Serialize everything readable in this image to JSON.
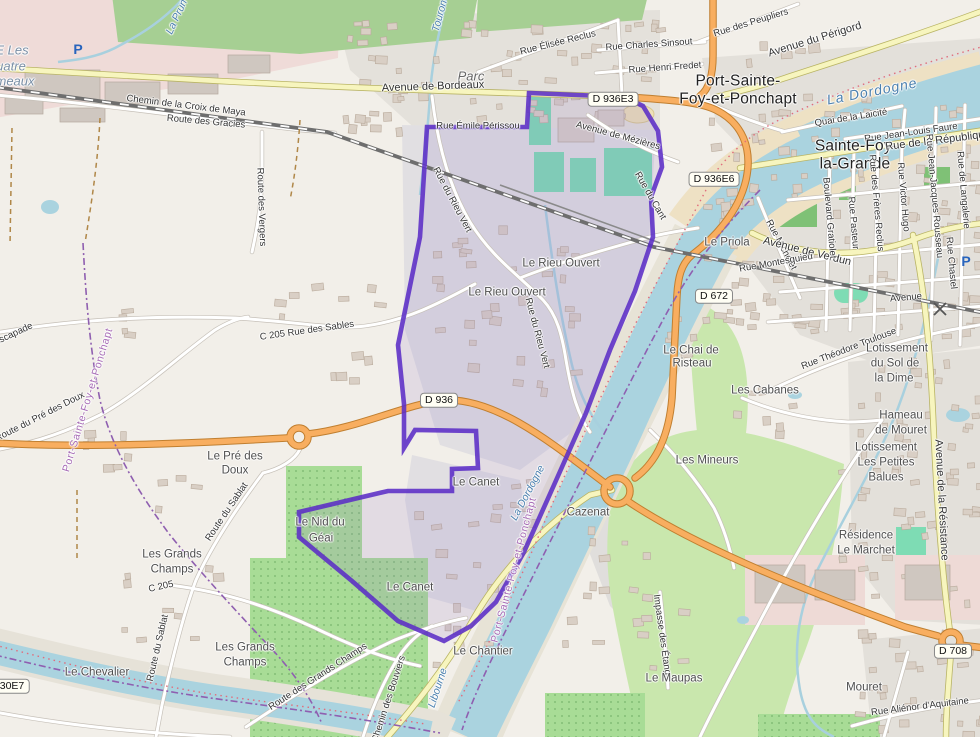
{
  "map_title": "Port-Sainte-Foy-et-Ponchapt commune boundary map",
  "boundary": {
    "name": "Port-Sainte-Foy-et-Ponchapt",
    "stroke_color": "#5b2ec6"
  },
  "colors": {
    "water": "#aad3df",
    "land": "#f2efe9",
    "forest": "#a6cf93",
    "grass": "#c9e7ad",
    "orchard": "#a8dc96",
    "pitch": "#7edcb4",
    "residential": "#e2e0db",
    "industrial": "#efdbd8",
    "primary_road": "#f8ae60",
    "secondary_road": "#f7f5be",
    "boundary_purple": "#5b2ec6",
    "railway": "#6e6e6e"
  },
  "labels": [
    {
      "t": "E Les",
      "x": 12,
      "y": 50,
      "r": 0,
      "k": "land"
    },
    {
      "t": "uatre",
      "x": 11,
      "y": 66,
      "r": 0,
      "k": "land"
    },
    {
      "t": "meaux",
      "x": 15,
      "y": 81,
      "r": 0,
      "k": "land"
    },
    {
      "t": "La Prun",
      "x": 177,
      "y": 17,
      "r": -65,
      "k": "wat"
    },
    {
      "t": "P",
      "x": 78,
      "y": 49,
      "r": 0,
      "k": "pk"
    },
    {
      "t": "Chemin de la Croix de Maya",
      "x": 186,
      "y": 106,
      "r": 7,
      "k": "road"
    },
    {
      "t": "Route des Gracies",
      "x": 206,
      "y": 122,
      "r": 5,
      "k": "road"
    },
    {
      "t": "Route des Vergers",
      "x": 261,
      "y": 207,
      "r": 88,
      "k": "road"
    },
    {
      "t": "Touron",
      "x": 440,
      "y": 16,
      "r": -75,
      "k": "wat"
    },
    {
      "t": "Parc",
      "x": 471,
      "y": 76,
      "r": 0,
      "k": "park"
    },
    {
      "t": "Avenue de Bordeaux",
      "x": 433,
      "y": 87,
      "r": -2,
      "k": "ryel"
    },
    {
      "t": "Rue Élisée Reclus",
      "x": 558,
      "y": 43,
      "r": -14,
      "k": "road"
    },
    {
      "t": "Rue Charles Sinsout",
      "x": 649,
      "y": 45,
      "r": -4,
      "k": "road"
    },
    {
      "t": "Rue Henri Fredet",
      "x": 665,
      "y": 68,
      "r": -4,
      "k": "road"
    },
    {
      "t": "Rue des Peupliers",
      "x": 751,
      "y": 23,
      "r": -17,
      "k": "road"
    },
    {
      "t": "Avenue du Périgord",
      "x": 815,
      "y": 40,
      "r": -17,
      "k": "ryel"
    },
    {
      "t": "Port-Sainte-",
      "x": 738,
      "y": 81,
      "r": 0,
      "k": "town"
    },
    {
      "t": "Foy-et-Ponchapt",
      "x": 738,
      "y": 99,
      "r": 0,
      "k": "town"
    },
    {
      "t": "La Dordogne",
      "x": 872,
      "y": 91,
      "r": -11,
      "k": "watb"
    },
    {
      "t": "Quai de la Laicité",
      "x": 851,
      "y": 118,
      "r": -9,
      "k": "road"
    },
    {
      "t": "Rue Jean-Louis Faure",
      "x": 911,
      "y": 133,
      "r": -8,
      "k": "road"
    },
    {
      "t": "Sainte-Foy-",
      "x": 856,
      "y": 146,
      "r": 0,
      "k": "town"
    },
    {
      "t": "la-Grande",
      "x": 855,
      "y": 164,
      "r": 0,
      "k": "town"
    },
    {
      "t": "Rue de la République",
      "x": 938,
      "y": 141,
      "r": -7,
      "k": "ryel"
    },
    {
      "t": "D 936E3",
      "x": 613,
      "y": 99,
      "r": 0,
      "k": "shld"
    },
    {
      "t": "D 936E6",
      "x": 714,
      "y": 179,
      "r": 0,
      "k": "shld"
    },
    {
      "t": "Rue Émile Périssou",
      "x": 478,
      "y": 126,
      "r": 0,
      "k": "road"
    },
    {
      "t": "Avenue de Mézières",
      "x": 618,
      "y": 136,
      "r": 15,
      "k": "road"
    },
    {
      "t": "Rue du Cant",
      "x": 650,
      "y": 196,
      "r": 60,
      "k": "road"
    },
    {
      "t": "Le Priola",
      "x": 727,
      "y": 243,
      "r": 0,
      "k": "sub"
    },
    {
      "t": "Rue Michelet",
      "x": 781,
      "y": 245,
      "r": 62,
      "k": "road"
    },
    {
      "t": "Avenue de Verdun",
      "x": 807,
      "y": 252,
      "r": 14,
      "k": "ryel"
    },
    {
      "t": "Rue Montesquieu",
      "x": 776,
      "y": 263,
      "r": -10,
      "k": "road"
    },
    {
      "t": "Boulevard Gratiolet",
      "x": 829,
      "y": 218,
      "r": 85,
      "k": "road"
    },
    {
      "t": "Rue Pasteur",
      "x": 853,
      "y": 223,
      "r": 85,
      "k": "road"
    },
    {
      "t": "Rue des Frères Reclus",
      "x": 876,
      "y": 203,
      "r": 85,
      "k": "road"
    },
    {
      "t": "Rue Victor Hugo",
      "x": 903,
      "y": 197,
      "r": 85,
      "k": "road"
    },
    {
      "t": "Rue Jean-Jacques Rousseau",
      "x": 934,
      "y": 196,
      "r": 85,
      "k": "road"
    },
    {
      "t": "Rue de Langalerie",
      "x": 963,
      "y": 190,
      "r": 85,
      "k": "road"
    },
    {
      "t": "Rue Chastel",
      "x": 951,
      "y": 263,
      "r": 85,
      "k": "road"
    },
    {
      "t": "Avenue",
      "x": 906,
      "y": 298,
      "r": -5,
      "k": "road"
    },
    {
      "t": "P",
      "x": 966,
      "y": 261,
      "r": 0,
      "k": "pk"
    },
    {
      "t": "D 672",
      "x": 714,
      "y": 296,
      "r": 0,
      "k": "shld"
    },
    {
      "t": "Rue Théodore Toulouse",
      "x": 849,
      "y": 349,
      "r": -21,
      "k": "road"
    },
    {
      "t": "Le Chai de",
      "x": 691,
      "y": 351,
      "r": 0,
      "k": "sub"
    },
    {
      "t": "Risteau",
      "x": 692,
      "y": 364,
      "r": 0,
      "k": "sub"
    },
    {
      "t": "Les Cabanes",
      "x": 765,
      "y": 391,
      "r": 0,
      "k": "sub"
    },
    {
      "t": "Lotissement",
      "x": 897,
      "y": 349,
      "r": 0,
      "k": "sub"
    },
    {
      "t": "du Sol de",
      "x": 895,
      "y": 364,
      "r": 0,
      "k": "sub"
    },
    {
      "t": "la Dime",
      "x": 894,
      "y": 379,
      "r": 0,
      "k": "sub"
    },
    {
      "t": "Hameau",
      "x": 901,
      "y": 416,
      "r": 0,
      "k": "sub"
    },
    {
      "t": "de Mouret",
      "x": 901,
      "y": 431,
      "r": 0,
      "k": "sub"
    },
    {
      "t": "Lotissement",
      "x": 886,
      "y": 448,
      "r": 0,
      "k": "sub"
    },
    {
      "t": "Les Petites",
      "x": 886,
      "y": 463,
      "r": 0,
      "k": "sub"
    },
    {
      "t": "Balues",
      "x": 886,
      "y": 478,
      "r": 0,
      "k": "sub"
    },
    {
      "t": "Les Mineurs",
      "x": 707,
      "y": 461,
      "r": 0,
      "k": "sub"
    },
    {
      "t": "Avenue de la Résistance",
      "x": 941,
      "y": 500,
      "r": 87,
      "k": "ryel"
    },
    {
      "t": "Résidence",
      "x": 866,
      "y": 536,
      "r": 0,
      "k": "sub"
    },
    {
      "t": "Le Marchet",
      "x": 866,
      "y": 551,
      "r": 0,
      "k": "sub"
    },
    {
      "t": "Impasse des Étangs",
      "x": 662,
      "y": 637,
      "r": 82,
      "k": "road"
    },
    {
      "t": "Le Maupas",
      "x": 674,
      "y": 679,
      "r": 0,
      "k": "sub"
    },
    {
      "t": "Mouret",
      "x": 864,
      "y": 688,
      "r": 0,
      "k": "sub"
    },
    {
      "t": "Rue Aliénor d'Aquitaine",
      "x": 920,
      "y": 707,
      "r": -7,
      "k": "road"
    },
    {
      "t": "D 708",
      "x": 953,
      "y": 651,
      "r": 0,
      "k": "shld"
    },
    {
      "t": "Le Rieu Ouvert",
      "x": 561,
      "y": 264,
      "r": 0,
      "k": "sub"
    },
    {
      "t": "Le Rieu Ouvert",
      "x": 507,
      "y": 293,
      "r": 0,
      "k": "sub"
    },
    {
      "t": "Rue du Rieu Vert",
      "x": 452,
      "y": 200,
      "r": 62,
      "k": "road"
    },
    {
      "t": "Rue du Rieu Vert",
      "x": 537,
      "y": 333,
      "r": 75,
      "k": "road"
    },
    {
      "t": "C 205 Rue des Sables",
      "x": 307,
      "y": 331,
      "r": -8,
      "k": "road"
    },
    {
      "t": "L'Escapade",
      "x": 10,
      "y": 336,
      "r": -25,
      "k": "road"
    },
    {
      "t": "Port-Sainte-Foy-et-Ponchapt",
      "x": 88,
      "y": 400,
      "r": -73,
      "k": "adm"
    },
    {
      "t": "Route du Pré des Doux",
      "x": 40,
      "y": 417,
      "r": -27,
      "k": "road"
    },
    {
      "t": "Le Pré des",
      "x": 235,
      "y": 457,
      "r": 0,
      "k": "sub"
    },
    {
      "t": "Doux",
      "x": 235,
      "y": 471,
      "r": 0,
      "k": "sub"
    },
    {
      "t": "D 936",
      "x": 439,
      "y": 400,
      "r": 0,
      "k": "shld"
    },
    {
      "t": "Les Grands",
      "x": 172,
      "y": 555,
      "r": 0,
      "k": "sub"
    },
    {
      "t": "Champs",
      "x": 172,
      "y": 570,
      "r": 0,
      "k": "sub"
    },
    {
      "t": "Route du Sablat",
      "x": 227,
      "y": 512,
      "r": -56,
      "k": "road"
    },
    {
      "t": "Route du Sablat",
      "x": 158,
      "y": 648,
      "r": -77,
      "k": "road"
    },
    {
      "t": "C 205",
      "x": 161,
      "y": 587,
      "r": -12,
      "k": "road"
    },
    {
      "t": "Les Grands",
      "x": 245,
      "y": 648,
      "r": 0,
      "k": "sub"
    },
    {
      "t": "Champs",
      "x": 245,
      "y": 663,
      "r": 0,
      "k": "sub"
    },
    {
      "t": "Le Chevalier",
      "x": 97,
      "y": 673,
      "r": 0,
      "k": "sub"
    },
    {
      "t": "30E7",
      "x": 12,
      "y": 686,
      "r": 0,
      "k": "shld"
    },
    {
      "t": "Route des Grands Champs",
      "x": 318,
      "y": 677,
      "r": -33,
      "k": "road"
    },
    {
      "t": "Chemin des Bouviers",
      "x": 389,
      "y": 699,
      "r": -72,
      "k": "road"
    },
    {
      "t": "Le Nid du",
      "x": 320,
      "y": 523,
      "r": 0,
      "k": "sub"
    },
    {
      "t": "Géai",
      "x": 321,
      "y": 539,
      "r": 0,
      "k": "sub"
    },
    {
      "t": "Le Canet",
      "x": 476,
      "y": 483,
      "r": 0,
      "k": "sub"
    },
    {
      "t": "Le Canet",
      "x": 410,
      "y": 588,
      "r": 0,
      "k": "sub"
    },
    {
      "t": "Port-Sainte-Foy-et-Ponchapt",
      "x": 514,
      "y": 570,
      "r": -75,
      "k": "adm"
    },
    {
      "t": "La Dordogne",
      "x": 528,
      "y": 493,
      "r": -62,
      "k": "wat"
    },
    {
      "t": "Libourne",
      "x": 438,
      "y": 688,
      "r": -72,
      "k": "wat"
    },
    {
      "t": "Le Chantier",
      "x": 483,
      "y": 652,
      "r": 0,
      "k": "sub"
    },
    {
      "t": "Cazenat",
      "x": 588,
      "y": 513,
      "r": 0,
      "k": "sub"
    }
  ]
}
